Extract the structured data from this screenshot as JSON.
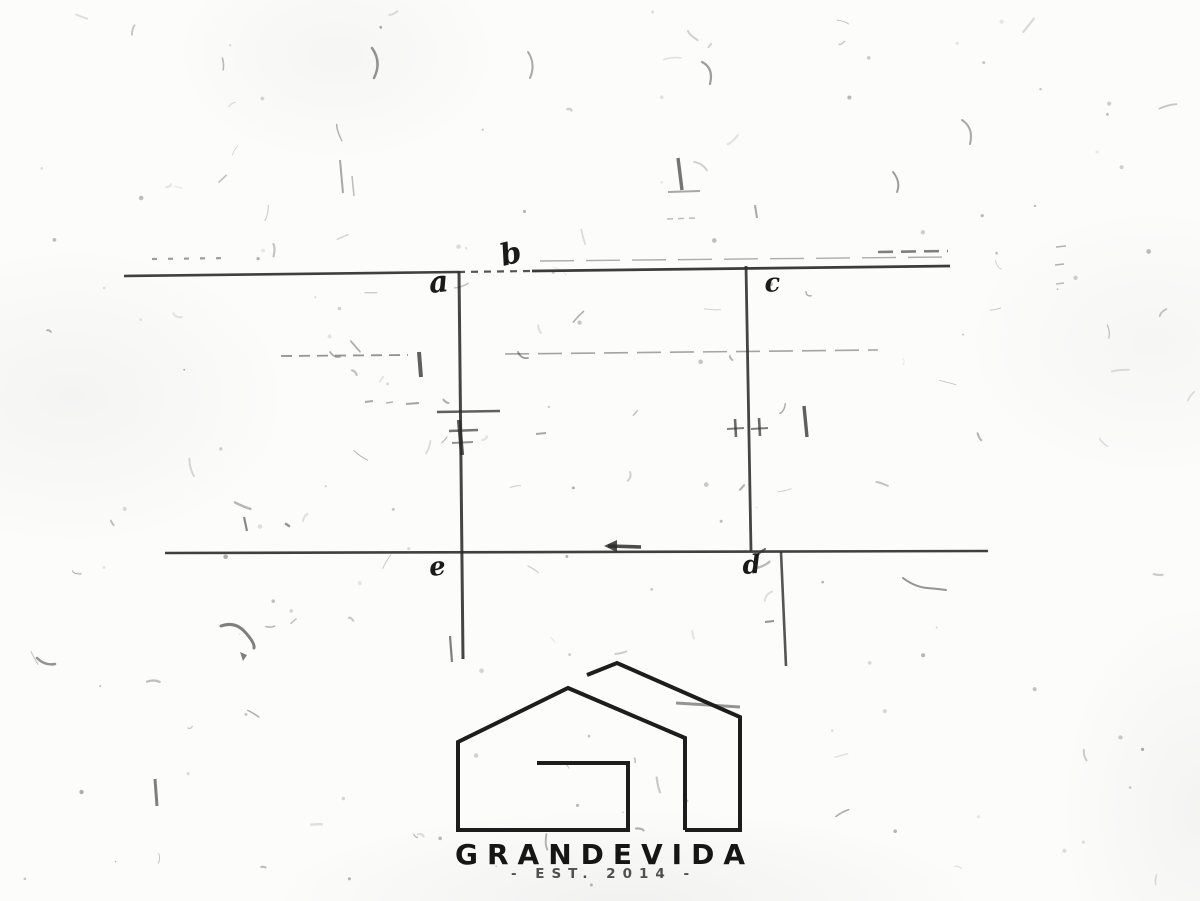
{
  "page": {
    "background": "#fcfcfb",
    "ink": "#2b2b2b"
  },
  "sketch": {
    "ink": "#2b2b2b",
    "labels": [
      {
        "id": "corner-label-a",
        "text": "a",
        "x": 430,
        "y": 293,
        "size": 30,
        "rotate": -6
      },
      {
        "id": "corner-label-b",
        "text": "b",
        "x": 503,
        "y": 266,
        "size": 30,
        "rotate": -14
      },
      {
        "id": "corner-label-c",
        "text": "c",
        "x": 765,
        "y": 292,
        "size": 26,
        "rotate": -4
      },
      {
        "id": "corner-label-e",
        "text": "e",
        "x": 430,
        "y": 576,
        "size": 26,
        "rotate": -6
      },
      {
        "id": "corner-label-d",
        "text": "d",
        "x": 743,
        "y": 574,
        "size": 26,
        "rotate": -4
      }
    ],
    "segments": [
      {
        "x1": 124,
        "y1": 276,
        "x2": 458,
        "y2": 272,
        "w": 2.6,
        "o": 0.9
      },
      {
        "x1": 458,
        "y1": 272,
        "x2": 532,
        "y2": 271,
        "w": 2.2,
        "o": 0.8,
        "dash": "7 6"
      },
      {
        "x1": 532,
        "y1": 271,
        "x2": 950,
        "y2": 266,
        "w": 2.8,
        "o": 0.92
      },
      {
        "x1": 540,
        "y1": 261,
        "x2": 946,
        "y2": 257,
        "w": 1.4,
        "o": 0.38,
        "dash": "34 12"
      },
      {
        "x1": 152,
        "y1": 259,
        "x2": 232,
        "y2": 258,
        "w": 2.2,
        "o": 0.45,
        "dash": "5 11"
      },
      {
        "x1": 878,
        "y1": 252,
        "x2": 948,
        "y2": 251,
        "w": 2.6,
        "o": 0.6,
        "dash": "15 8"
      },
      {
        "x1": 459,
        "y1": 271,
        "x2": 463,
        "y2": 659,
        "w": 3,
        "o": 0.88
      },
      {
        "x1": 450,
        "y1": 636,
        "x2": 452,
        "y2": 662,
        "w": 2.2,
        "o": 0.6
      },
      {
        "x1": 746,
        "y1": 266,
        "x2": 751,
        "y2": 551,
        "w": 2.8,
        "o": 0.88
      },
      {
        "x1": 165,
        "y1": 553,
        "x2": 988,
        "y2": 551,
        "w": 2.6,
        "o": 0.9
      },
      {
        "x1": 781,
        "y1": 552,
        "x2": 786,
        "y2": 666,
        "w": 2.6,
        "o": 0.8
      },
      {
        "x1": 281,
        "y1": 356,
        "x2": 408,
        "y2": 355,
        "w": 1.8,
        "o": 0.5,
        "dash": "11 7"
      },
      {
        "x1": 419,
        "y1": 352,
        "x2": 421,
        "y2": 377,
        "w": 4,
        "o": 0.75
      },
      {
        "x1": 505,
        "y1": 354,
        "x2": 878,
        "y2": 350,
        "w": 1.6,
        "o": 0.42,
        "dash": "24 9"
      },
      {
        "x1": 365,
        "y1": 402,
        "x2": 373,
        "y2": 401,
        "w": 2,
        "o": 0.4
      },
      {
        "x1": 386,
        "y1": 403,
        "x2": 393,
        "y2": 402,
        "w": 1.6,
        "o": 0.35
      },
      {
        "x1": 406,
        "y1": 404,
        "x2": 419,
        "y2": 403,
        "w": 2,
        "o": 0.42
      },
      {
        "x1": 437,
        "y1": 412,
        "x2": 500,
        "y2": 411,
        "w": 2.4,
        "o": 0.75
      },
      {
        "x1": 459,
        "y1": 420,
        "x2": 462,
        "y2": 455,
        "w": 4.2,
        "o": 0.8
      },
      {
        "x1": 449,
        "y1": 431,
        "x2": 478,
        "y2": 430,
        "w": 2.6,
        "o": 0.65
      },
      {
        "x1": 452,
        "y1": 443,
        "x2": 473,
        "y2": 442,
        "w": 2,
        "o": 0.5
      },
      {
        "x1": 536,
        "y1": 434,
        "x2": 546,
        "y2": 433,
        "w": 2,
        "o": 0.4
      },
      {
        "x1": 735,
        "y1": 419,
        "x2": 736,
        "y2": 437,
        "w": 2.6,
        "o": 0.7
      },
      {
        "x1": 759,
        "y1": 418,
        "x2": 760,
        "y2": 436,
        "w": 2.6,
        "o": 0.7
      },
      {
        "x1": 727,
        "y1": 429,
        "x2": 744,
        "y2": 428,
        "w": 2,
        "o": 0.6
      },
      {
        "x1": 751,
        "y1": 429,
        "x2": 768,
        "y2": 428,
        "w": 2,
        "o": 0.6
      },
      {
        "x1": 804,
        "y1": 406,
        "x2": 807,
        "y2": 437,
        "w": 3.4,
        "o": 0.75
      },
      {
        "x1": 608,
        "y1": 546,
        "x2": 641,
        "y2": 547,
        "w": 3.6,
        "o": 0.85
      },
      {
        "x1": 765,
        "y1": 622,
        "x2": 774,
        "y2": 621,
        "w": 2,
        "o": 0.5
      },
      {
        "x1": 676,
        "y1": 703,
        "x2": 740,
        "y2": 707,
        "w": 3,
        "o": 0.5
      },
      {
        "x1": 340,
        "y1": 160,
        "x2": 343,
        "y2": 193,
        "w": 2,
        "o": 0.4
      },
      {
        "x1": 352,
        "y1": 176,
        "x2": 354,
        "y2": 196,
        "w": 1.5,
        "o": 0.3
      },
      {
        "x1": 678,
        "y1": 158,
        "x2": 682,
        "y2": 190,
        "w": 3.4,
        "o": 0.65
      },
      {
        "x1": 668,
        "y1": 192,
        "x2": 700,
        "y2": 191,
        "w": 2,
        "o": 0.4
      },
      {
        "x1": 755,
        "y1": 205,
        "x2": 757,
        "y2": 218,
        "w": 2,
        "o": 0.4
      },
      {
        "x1": 667,
        "y1": 219,
        "x2": 697,
        "y2": 218,
        "w": 1.5,
        "o": 0.3,
        "dash": "6 5"
      },
      {
        "x1": 155,
        "y1": 779,
        "x2": 157,
        "y2": 806,
        "w": 3,
        "o": 0.6
      },
      {
        "x1": 244,
        "y1": 517,
        "x2": 247,
        "y2": 531,
        "w": 2.2,
        "o": 0.55
      },
      {
        "x1": 1056,
        "y1": 247,
        "x2": 1066,
        "y2": 246,
        "w": 1.6,
        "o": 0.35
      },
      {
        "x1": 1055,
        "y1": 265,
        "x2": 1064,
        "y2": 264,
        "w": 1.6,
        "o": 0.35
      },
      {
        "x1": 1056,
        "y1": 284,
        "x2": 1064,
        "y2": 283,
        "w": 1.6,
        "o": 0.3
      }
    ],
    "paths": [
      {
        "d": "M 903 578 q 12 9 24 10 t 19 2",
        "w": 2,
        "o": 0.5
      },
      {
        "d": "M 221 626 q 14 -5 24 6 t 9 16",
        "w": 3,
        "o": 0.6
      },
      {
        "d": "M 37 658 q 8 8 18 6",
        "w": 2.5,
        "o": 0.5
      },
      {
        "d": "M 893 172 q 8 10 4 20",
        "w": 2,
        "o": 0.45
      },
      {
        "d": "M 962 120 q 12 8 8 24",
        "w": 2,
        "o": 0.4
      },
      {
        "d": "M 372 48 q 10 14 2 30",
        "w": 2.5,
        "o": 0.5
      },
      {
        "d": "M 702 62 q 12 6 8 22",
        "w": 2.2,
        "o": 0.45
      },
      {
        "d": "M 528 52 q 8 12 2 26",
        "w": 2,
        "o": 0.4
      },
      {
        "d": "M 330 352 q 4 6 10 5",
        "w": 1.6,
        "o": 0.4
      },
      {
        "d": "M 518 352 q 3 7 10 6",
        "w": 1.8,
        "o": 0.45
      },
      {
        "d": "M 757 556 q 4 -5 8 -7",
        "w": 2,
        "o": 0.7
      },
      {
        "d": "M 286 524 l 3 2",
        "w": 2.5,
        "o": 0.5
      }
    ],
    "polygons": [
      {
        "points": "604,546 617,540 617,552",
        "o": 0.85
      },
      {
        "points": "240,652 247,655 243,661",
        "o": 0.6
      }
    ]
  },
  "logo": {
    "brand": "GRANDEVIDA",
    "tagline": "- EST. 2014 -",
    "color": "#1d1d1d",
    "stroke_width": 4,
    "house_paths": [
      {
        "points": [
          [
            537,
            763
          ],
          [
            628,
            763
          ],
          [
            628,
            830
          ],
          [
            458,
            830
          ],
          [
            458,
            742
          ],
          [
            568,
            688
          ],
          [
            685,
            738
          ],
          [
            685,
            830
          ]
        ]
      },
      {
        "points": [
          [
            587,
            675
          ],
          [
            617,
            663
          ],
          [
            740,
            717
          ],
          [
            740,
            830
          ],
          [
            685,
            830
          ]
        ]
      }
    ]
  }
}
